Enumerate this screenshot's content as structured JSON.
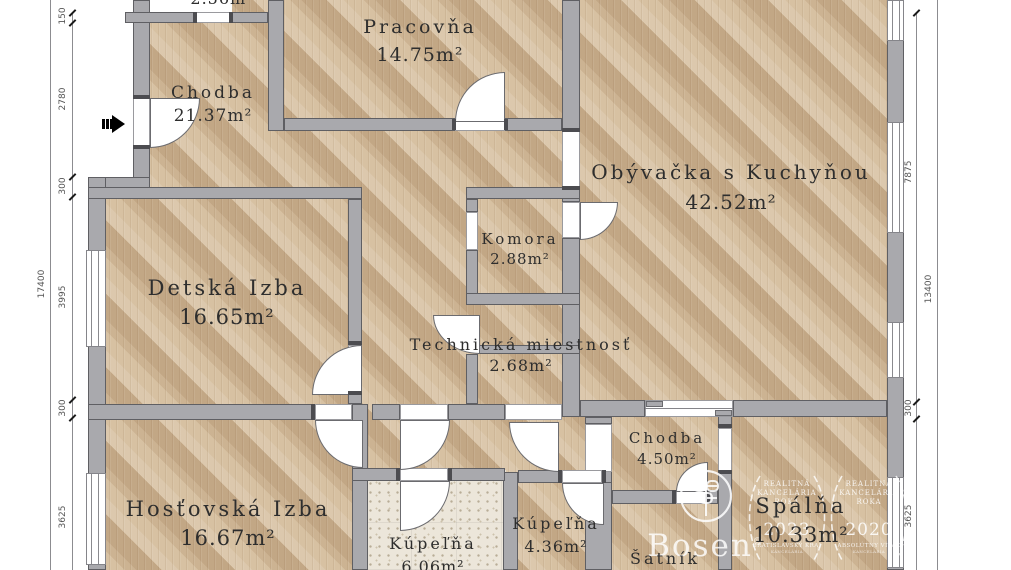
{
  "rooms": [
    {
      "name": "",
      "area": "2.56m²"
    },
    {
      "name": "Pracovňa",
      "area": "14.75m²"
    },
    {
      "name": "Chodba",
      "area": "21.37m²"
    },
    {
      "name": "Obývačka s Kuchyňou",
      "area": "42.52m²"
    },
    {
      "name": "Komora",
      "area": "2.88m²"
    },
    {
      "name": "Detská Izba",
      "area": "16.65m²"
    },
    {
      "name": "Technická miestnosť",
      "area": "2.68m²"
    },
    {
      "name": "Chodba",
      "area": "4.50m²"
    },
    {
      "name": "Hosťovská Izba",
      "area": "16.67m²"
    },
    {
      "name": "Kúpeľňa",
      "area": "6.06m²"
    },
    {
      "name": "Kúpeľňa",
      "area": "4.36m²"
    },
    {
      "name": "Šatník",
      "area": ""
    },
    {
      "name": "Spálňa",
      "area": "10.33m²"
    }
  ],
  "dimensions": {
    "left_total": "17400",
    "left_segments": [
      "150",
      "2780",
      "300",
      "3995",
      "300",
      "3625"
    ],
    "right_total": "13400",
    "right_segments": [
      "7875",
      "300",
      "3625"
    ]
  },
  "watermark": {
    "brand": "Bosen",
    "awards": [
      {
        "line1": "REALITNÁ",
        "line2": "KANCELÁRIA",
        "line3": "ROKA",
        "year": "2023",
        "subtitle": "BRATISLAVSKÝ KRAJ"
      },
      {
        "line1": "REALITNÁ",
        "line2": "KANCELÁRIA",
        "line3": "ROKA",
        "year": "2020",
        "subtitle": "ABSOLÚTNY VÍŤAZ"
      }
    ]
  },
  "colors": {
    "wall": "#a9a9ad",
    "wall_outline": "#5f5f63",
    "wood": "#d7c1a2",
    "tile": "#ece6da",
    "label": "#2e2e2e"
  }
}
